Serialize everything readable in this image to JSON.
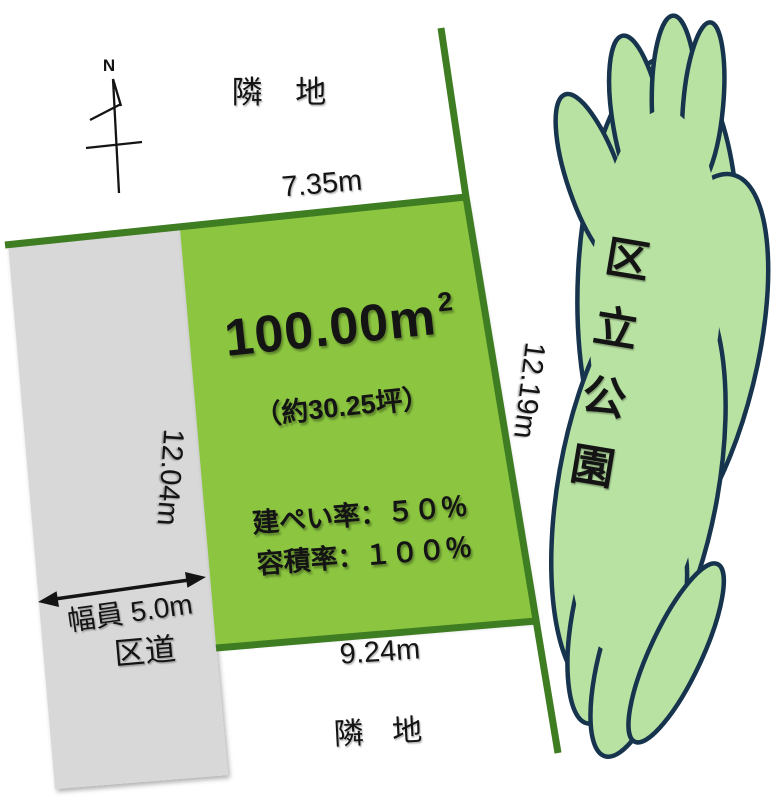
{
  "title": "土地区画図",
  "compass": {
    "label": "N"
  },
  "labels": {
    "neighbor_top": "隣 地",
    "neighbor_bottom": "隣 地",
    "top_dim": "7.35m",
    "right_dim": "12.19m",
    "left_dim": "12.04m",
    "bottom_dim": "9.24m",
    "road_width": "幅員 5.0m",
    "road_name": "区道",
    "park_name_chars": [
      "区",
      "立",
      "公",
      "園"
    ]
  },
  "plot": {
    "area_value": "100.00",
    "area_unit": "m",
    "area_unit_sup": "2",
    "tsubo": "（約30.25坪）",
    "coverage_ratio": "建ぺい率：５０％",
    "floor_area_ratio": "容積率：１００％"
  },
  "colors": {
    "plot_fill": "#8CC63F",
    "boundary_green": "#3F7D23",
    "road_fill": "#D8D8D8",
    "park_fill": "#B8E2A2",
    "park_outline": "#17344E",
    "text": "#141414"
  }
}
